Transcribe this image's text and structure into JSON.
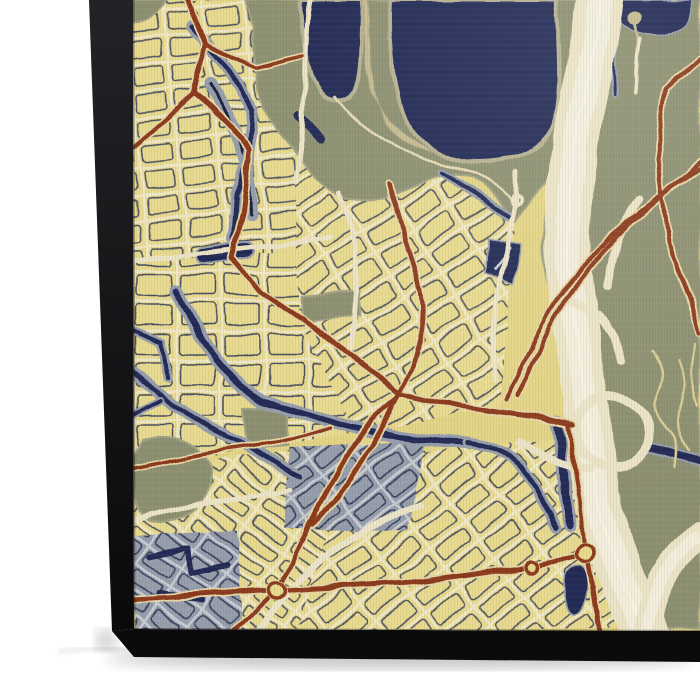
{
  "scene": {
    "background": "#ffffff",
    "description": "canvas-print-of-stylized-city-map"
  },
  "palette": {
    "base": "#e3d484",
    "blockYellow": "#e8da8e",
    "blockYellow2": "#dfcf7c",
    "street": "#efe8c8",
    "navy": "#232c55",
    "navyDark": "#1a2242",
    "slate": "#979eab",
    "slateLight": "#c9cdd2",
    "slateDark": "#6e7890",
    "olive": "#8d9070",
    "oliveLight": "#a2a384",
    "oliveDark": "#73765a",
    "tan": "#c7bb8e",
    "tanLine": "#e6dab2",
    "cream": "#ece4c6",
    "creamCore": "#f5f0de",
    "creamLine": "#f8f3e3",
    "red": "#8c3a1e",
    "casing": "#e7d7a6",
    "sideTop": "#232327",
    "sideBottom": "#0a0a0c",
    "sideUnder": "#0b0b0d"
  },
  "print": {
    "side_left": "89,0 133,0 134,629 112,631",
    "side_bottom": "112,631 134,629 700,631 700,662 134,657",
    "shadow": {
      "ellipse": {
        "cx": 400,
        "cy": 658,
        "rx": 295,
        "ry": 11,
        "opacity": 0.22
      },
      "wisp": "M58,652 C110,644 150,650 215,658",
      "corner": {
        "cx": 106,
        "cy": 640,
        "r": 11,
        "opacity": 0.18
      }
    },
    "face_clip": "M133,0 L700,0 L700,631 L134,629 Z"
  },
  "map": {
    "districts": [
      {
        "id": "d1",
        "poly": "133,0 345,0 345,120 300,170 295,262 133,262",
        "rot": -6,
        "cell": [
          40,
          26
        ]
      },
      {
        "id": "d2",
        "poly": "133,262 350,245 362,432 133,470",
        "rot": 0,
        "cell": [
          44,
          30
        ]
      },
      {
        "id": "d3",
        "poly": "133,470 400,438 462,470 462,630 133,630",
        "rot": 36,
        "cell": [
          46,
          20
        ]
      },
      {
        "id": "d4",
        "poly": "295,163 447,166 516,222 500,406 358,432 298,320",
        "rot": -33,
        "cell": [
          44,
          26
        ]
      },
      {
        "id": "d5",
        "poly": "350,460 562,438 616,520 616,630 298,630",
        "rot": -38,
        "cell": [
          44,
          24
        ]
      },
      {
        "id": "d6",
        "poly": "622,16 700,10 700,140 680,150 640,120 628,60",
        "rot": 3,
        "cell": [
          30,
          22
        ]
      },
      {
        "id": "d7",
        "poly": "650,195 700,188 700,332 660,325 648,260",
        "rot": -8,
        "cell": [
          34,
          24
        ]
      }
    ],
    "slate_districts": [
      {
        "id": "s1",
        "poly": "290,448 425,440 408,532 283,527",
        "rot": -38,
        "cell": [
          40,
          22
        ]
      },
      {
        "id": "s2",
        "poly": "134,535 238,530 242,630 134,630",
        "rot": 36,
        "cell": [
          40,
          22
        ]
      }
    ],
    "slate_bands": [
      {
        "d": "M210,85 L248,160 L250,215",
        "w": 13,
        "core": 3
      }
    ],
    "olive": [
      {
        "d": "M245,0 C258,42 249,88 271,121 C300,158 320,188 342,198 C366,208 402,190 432,179 C452,171 472,172 490,189 L516,223 C532,197 551,180 566,158 C582,130 593,99 598,60 L602,0 Z"
      },
      {
        "d": "M612,0 L700,0 L700,630 L648,630 C636,560 620,520 616,470 C610,420 600,380 568,330 C548,298 538,258 546,212 C554,170 574,128 590,88 C600,58 608,28 612,0 Z"
      },
      {
        "d": "M133,0 L165,0 C162,12 150,22 133,24 Z"
      },
      {
        "d": "M142,438 C175,430 205,444 210,472 C214,500 190,520 165,522 C148,523 136,512 134,495 L133,455 Z"
      },
      {
        "d": "M243,408 L285,404 L289,446 L247,450 Z"
      },
      {
        "d": "M300,296 L360,290 L362,316 L302,322 Z"
      }
    ],
    "water": {
      "lake_lobes": [
        "M300,0 C301,35 305,68 318,88 C330,105 348,100 355,88 C362,70 360,35 362,0 Z",
        "M390,0 C388,40 392,80 402,112 C414,145 445,162 478,163 C510,164 540,150 552,128 C562,105 560,60 558,28 L556,0 Z"
      ],
      "island": "M362,0 C364,45 362,75 375,100 C385,118 398,130 415,142 L432,152 C413,150 396,140 386,124 C375,106 371,70 369,35 L368,0 Z",
      "shore_line": "M335,95 C362,130 400,156 450,166 C482,172 504,186 515,205",
      "canals": [
        {
          "d": "M192,26 L228,68 L253,112 L249,158 L236,196 L233,238",
          "casing": 12,
          "core": 5
        },
        {
          "d": "M176,292 L196,330 L216,360 L243,388 L262,400 L300,412 L352,427 L400,437 L442,442 L468,443",
          "casing": 13,
          "core": 6
        },
        {
          "d": "M133,372 L172,404 L228,438 L268,458 L300,478",
          "casing": 12,
          "core": 5
        },
        {
          "d": "M468,443 C490,446 505,452 514,462 C530,480 545,505 556,528",
          "casing": 11,
          "core": 5
        },
        {
          "d": "M612,30 L615,95",
          "casing": 7,
          "core": 3
        },
        {
          "d": "M133,330 L163,343 L168,378",
          "casing": 9,
          "core": 4
        },
        {
          "d": "M133,414 L160,400",
          "casing": 8,
          "core": 4
        },
        {
          "d": "M150,556 L188,548 L192,574 L228,566",
          "casing": 0,
          "core": 6
        },
        {
          "d": "M158,592 L202,602",
          "casing": 0,
          "core": 5
        },
        {
          "d": "M300,116 L322,138",
          "casing": 0,
          "core": 9
        },
        {
          "d": "M443,173 L480,196 L510,218",
          "casing": 9,
          "core": 4
        },
        {
          "d": "M557,424 C566,456 561,492 571,524",
          "casing": 14,
          "core": 8
        },
        {
          "d": "M648,448 L700,462",
          "casing": 11,
          "core": 7
        }
      ],
      "ponds": [
        {
          "type": "rrect",
          "x": 196,
          "y": 244,
          "w": 58,
          "h": 17,
          "rot": -7,
          "rx": 7
        },
        {
          "type": "path",
          "d": "M570,568 C580,562 588,568 588,582 C588,598 582,612 574,616 C566,612 562,596 563,584 C564,574 566,572 570,568 Z"
        },
        {
          "type": "poly",
          "points": "488,238 521,247 513,284 484,273",
          "slash": "M494,270 L510,248"
        },
        {
          "type": "path",
          "d": "M614,0 L692,0 C694,14 690,26 678,32 C658,40 636,36 622,26 C616,18 614,10 614,0 Z"
        }
      ],
      "culdesac": {
        "x": 634,
        "y": 19,
        "r": 7,
        "stem": "M634,26 L639,44"
      }
    },
    "highway": {
      "main": "M601,-10 C596,50 572,130 568,210 C565,290 584,360 590,440 C594,505 612,560 648,640",
      "main_w": 46,
      "core_w": 24,
      "branch": "M700,536 C668,556 650,590 646,640",
      "branch_w": 26,
      "loop": {
        "x": 612,
        "y": 432,
        "r": 36,
        "w": 9
      },
      "ramps": [
        "M568,300 C600,312 618,334 622,362",
        "M590,470 C562,468 540,456 520,442",
        "M640,198 C620,228 610,258 607,288"
      ]
    },
    "squiggles": [
      "M652,350 q15,20 5,40 q-10,20 8,38 q18,16 10,40",
      "M678,360 q12,25 2,48 q-10,22 10,44",
      "M695,345 q-8,30 4,60"
    ],
    "arterials": [
      {
        "d": "M310,0 C300,60 310,120 295,180",
        "w": 5
      },
      {
        "d": "M133,262 C200,252 260,246 330,238",
        "w": 5
      },
      {
        "d": "M340,195 C360,240 360,300 352,350",
        "w": 5
      },
      {
        "d": "M517,172 L516,205 C512,235 502,262 497,295 C494,320 492,350 495,380",
        "w": 5
      },
      {
        "d": "M260,630 C300,570 350,530 420,505",
        "w": 7
      },
      {
        "d": "M133,520 C190,505 240,498 290,492",
        "w": 5
      },
      {
        "d": "M640,40 L636,92",
        "w": 4
      }
    ],
    "red": {
      "roads": [
        {
          "d": "M186,-5 L206,44 L193,92 L250,148 L243,212 L232,258 L262,292 L300,318 L352,356 L400,392 L462,407 L540,418 L572,426",
          "w": 5
        },
        {
          "d": "M506,400 C520,372 532,346 546,318 C563,288 602,240 650,204 C672,188 688,177 700,170",
          "w": 4
        },
        {
          "d": "M517,396 C531,369 543,341 557,314 C574,284 610,238 658,200 C676,186 690,175 700,163",
          "w": 4
        },
        {
          "d": "M700,60 L666,90 L657,160 L668,242 L692,302 L700,334",
          "w": 4
        },
        {
          "d": "M133,600 L277,591 L410,583 L533,566 L586,553",
          "w": 5
        },
        {
          "d": "M586,553 L600,634",
          "w": 5
        },
        {
          "d": "M277,591 L232,634",
          "w": 4
        },
        {
          "d": "M277,591 L310,522 L345,458 L372,420 L398,396",
          "w": 4.5
        },
        {
          "d": "M586,553 C583,510 576,470 567,428",
          "w": 4
        },
        {
          "d": "M133,148 L170,116 L193,92",
          "w": 4
        },
        {
          "d": "M206,44 L256,68 L302,56",
          "w": 3.5
        },
        {
          "d": "M133,468 L212,452 L282,442 L332,428",
          "w": 3.5
        },
        {
          "d": "M388,182 C402,238 419,272 422,304 C425,334 410,372 394,404 C377,440 354,472 340,494 L312,524",
          "w": 4.5
        }
      ],
      "roundabouts": [
        {
          "x": 277,
          "y": 591,
          "r": 8
        },
        {
          "x": 533,
          "y": 566,
          "r": 6
        },
        {
          "x": 586,
          "y": 553,
          "r": 9
        }
      ],
      "cream_circle": {
        "x": 517,
        "y": 200,
        "r": 5
      }
    }
  }
}
